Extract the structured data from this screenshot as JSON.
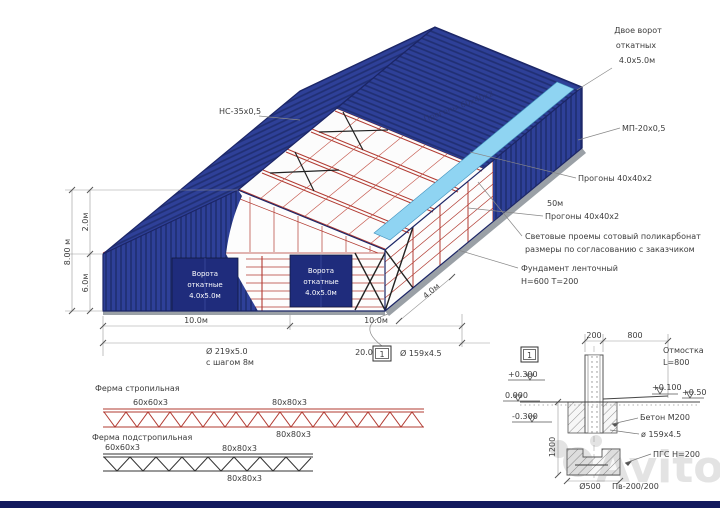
{
  "annotations": {
    "ns_profile": "НС-35х0,5",
    "mp_profile": "МП-20х0,5",
    "gates_line1": "Двое ворот",
    "gates_line2": "откатных",
    "gates_line3": "4.0х5.0м",
    "purlins_top": "Прогоны 40х40х2",
    "length_50m": "50м",
    "purlins_mid": "Прогоны 40х40х2",
    "roof_purlins_faint": "Прогоны 60х40х2",
    "skylight_line1": "Световые проемы сотовый поликарбонат",
    "skylight_line2": "размеры по согласованию с заказчиком",
    "foundation_line1": "Фундамент ленточный",
    "foundation_line2": "Н=600 Т=200"
  },
  "door": {
    "line1": "Ворота",
    "line2": "откатные",
    "line3": "4.0х5.0м"
  },
  "dimensions": {
    "height_total": "8.00 м",
    "height_upper": "2.0м",
    "height_lower": "6.0м",
    "width_left": "10.0м",
    "width_right": "10.0м",
    "pile_spec": "Ø 219х5.0",
    "pile_step": "с шагом 8м",
    "length_20": "20.0м",
    "pipe_spec": "Ø 159х4.5",
    "bay": "4.0м",
    "section_marker": "1"
  },
  "trusses": {
    "rafter": {
      "title": "Ферма стропильная",
      "label_left": "60х60х3",
      "label_right": "80х80х3",
      "label_bottom": "80х80х3"
    },
    "sub_rafter": {
      "title": "Ферма подстропильная",
      "label_left": "60х60х3",
      "label_right": "80х80х3",
      "label_bottom": "80х80х3"
    }
  },
  "detail": {
    "marker": "1",
    "dim_200": "200",
    "dim_800": "800",
    "otmostka_line1": "Отмостка",
    "otmostka_line2": "L=800",
    "level_plus300": "+0.300",
    "level_zero": "0.000",
    "level_minus300": "-0.300",
    "level_plus100": "+0.100",
    "level_plus50": "+0.50",
    "concrete": "Бетон М200",
    "pipe": "ø 159х4.5",
    "pgs": "ПГС Н=200",
    "dim_1200": "1200",
    "dim_500": "Ø500",
    "footing": "Пв-200/200"
  },
  "watermark": {
    "brand": "Avito"
  },
  "colors": {
    "cladding": "#2e4098",
    "cladding_dark": "#202f73",
    "frame_red": "#b23b32",
    "skylight": "#8fd4f2",
    "door": "#1f2c7c"
  }
}
